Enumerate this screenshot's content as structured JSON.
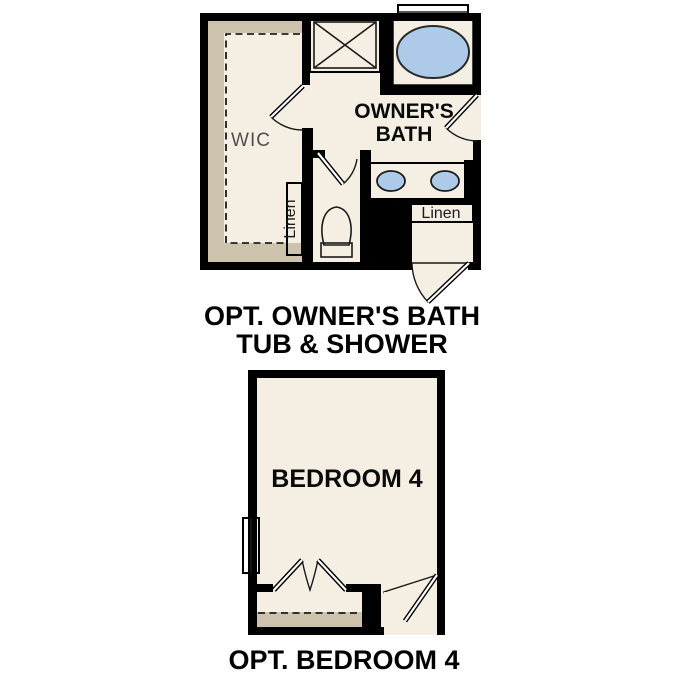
{
  "colors": {
    "floor": "#f5eee2",
    "cabinet_tan": "#cdc2ac",
    "fixture_blue": "#adcbe9",
    "wall": "#000000",
    "wic_text": "#4f4f4f"
  },
  "owners_bath_plan": {
    "caption_line1": "OPT. OWNER'S BATH",
    "caption_line2": "TUB & SHOWER",
    "wic_label": "WIC",
    "bath_label_line1": "OWNER'S",
    "bath_label_line2": "BATH",
    "wic_linen_label": "Linen",
    "hall_linen_label": "Linen"
  },
  "bedroom4_plan": {
    "caption": "OPT. BEDROOM 4",
    "room_label": "BEDROOM 4"
  }
}
